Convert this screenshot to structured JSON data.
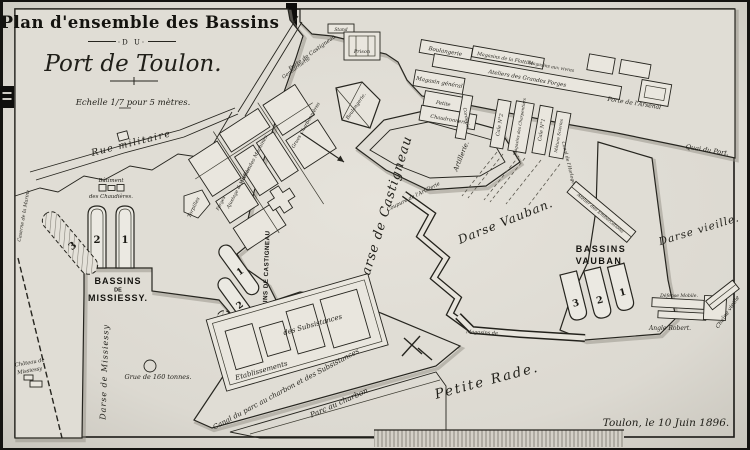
{
  "title": {
    "line1": "Plan d'ensemble des Bassins",
    "du": "·D U·",
    "line2": "Port de Toulon.",
    "scale": "Echelle 1/7 pour 5 mètres."
  },
  "signature": "Toulon, le 10 Juin 1896.",
  "areas": {
    "rue_militaire": "Rue militaire",
    "darse_missiessy": "Darse de Missiessy",
    "darse_castigneau": "Darse de Castigneau",
    "darse_vauban": "Darse Vauban.",
    "darse_vieille": "Darse vieille.",
    "petite_rade": "Petite Rade.",
    "quai_du_port": "Quai du Port.",
    "parc_charbon": "Parc au charbon",
    "canal_parc": "Canal du parc au charbon et des Subsistances",
    "chaine_vieille": "Chaîne vieille"
  },
  "bassins": {
    "missiessy": {
      "l1": "BASSINS",
      "l2": "DE",
      "l3": "MISSIESSY.",
      "n": [
        "2",
        "1",
        "3"
      ]
    },
    "castigneau": {
      "label": "BASSINS DE CASTIGNEAU",
      "n": [
        "1",
        "2",
        "3"
      ]
    },
    "vauban": {
      "l1": "BASSINS",
      "l2": "VAUBAN.",
      "n": [
        "3",
        "2",
        "1"
      ]
    }
  },
  "features": {
    "batiment_l1": "Bâtiment",
    "batiment_l2": "des Chaudières.",
    "caserne": "Caserne de la Marine",
    "chateau_l1": "Château de",
    "chateau_l2": "Missiessy",
    "grue": "Grue de 160 tonnes.",
    "torpilles": "Torpilles",
    "atelier_machines": "Atelier des Machines",
    "ajustage": "Ajustage & Modèles",
    "grues_charbonnieres": "Grues Charbonnières",
    "forges": "Forges",
    "porte_castigneau": "Porte de Castigneau",
    "gendarmerie": "Gendarmerie",
    "stand": "Stand",
    "prison": "Prison",
    "boulangerie_pentagone": "Boulangerie.",
    "boulangerie": "Boulangerie",
    "magasins_flottille": "Magasins de la Flottille",
    "magasins_vivres": "Magasins aux vivres",
    "grandes_forges": "Ateliers des Grandes Forges",
    "magasin_general": "Magasin général",
    "petite": "Petite",
    "chaudronnerie": "Chaudronnerie",
    "corderie": "Corderie",
    "cale2": "Cale N°2",
    "charpentiers": "Magasins des Charpentiers",
    "cale1": "Cale N°1",
    "mature_scieries": "Mâture Scieries",
    "porte_arsenal": "Porte de l'Arsenal",
    "canal_horloge": "Canal de l'Horloge",
    "atelier_embarcations": "Atelier des Embarcations",
    "artillerie": "Artillerie.",
    "coupure": "Coupure de l'Artillerie",
    "defense_mobile": "Défense Mobile.",
    "angle_robert": "Angle Robert.",
    "etablissements": "Etablissements",
    "subsistances": "des Subsistances",
    "magasins_jetee": "Magasins de"
  },
  "palette": {
    "paper": "#e0ddd5",
    "water": "#ebe9e2",
    "ink": "#26251f",
    "shadow": "#938f86",
    "photo_background": "#141310"
  }
}
